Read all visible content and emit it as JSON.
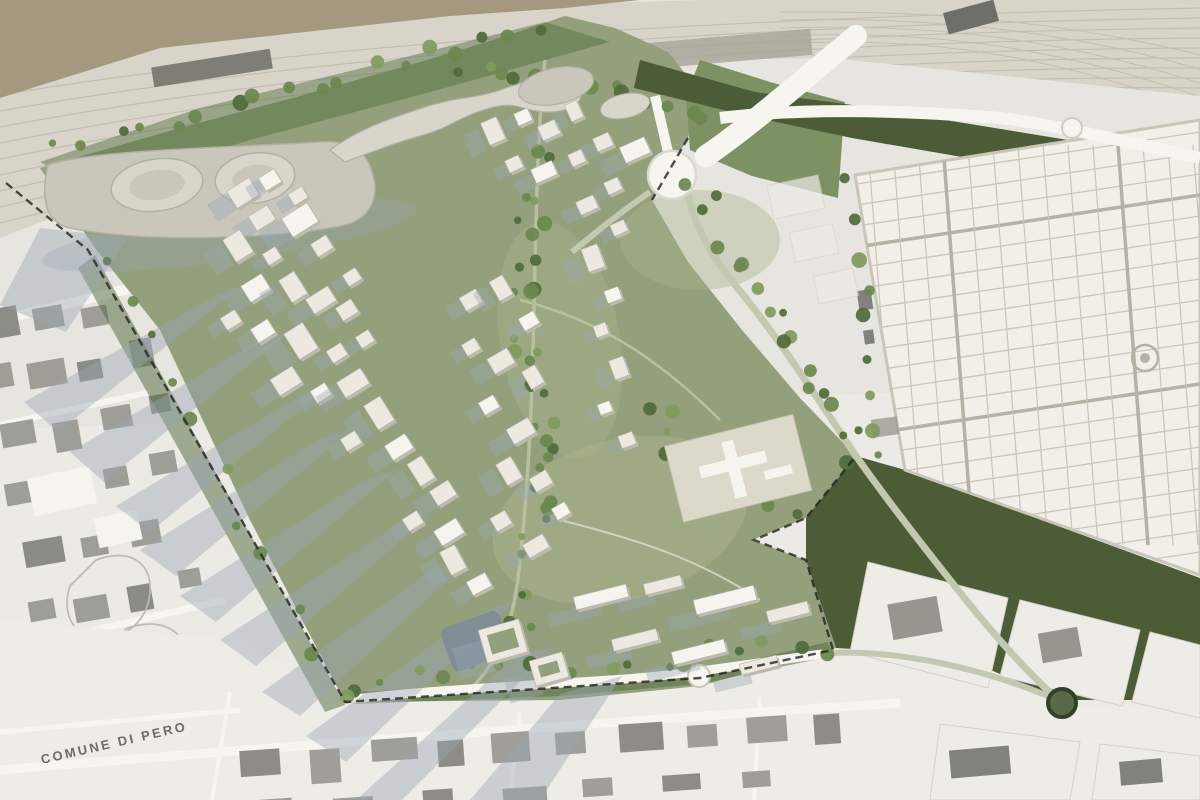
{
  "labels": {
    "municipality": "COMUNE DI PERO"
  },
  "colors": {
    "map_base": "#e7e5df",
    "map_light": "#eeece6",
    "out_of_map": "#a4987f",
    "rail_base": "#d8d4c9",
    "rail_line": "#c2beb1",
    "platform_dark": "#6f6f69",
    "platform_mid": "#a8a49b",
    "road_white": "#f6f5f0",
    "footprint": "#96968f",
    "footprint_dark": "#82827c",
    "parcel_line": "#bdb9ae",
    "site_green": "#93a07b",
    "lawn_green": "#aab38d",
    "park_green": "#7e9163",
    "olive_dark": "#4c5c37",
    "tree_dark": "#4f6a3b",
    "tree_mid": "#6b874e",
    "tree_light": "#7f9a5d",
    "building_roof": "#ebe9e0",
    "building_side": "#bdbaae",
    "building_bright": "#f5f4ef",
    "pavilion_grey": "#c9c6bb",
    "pavilion_light": "#d8d5ca",
    "pavilion_dark": "#b3b0a4",
    "shadow_blue": "#9aa7b5",
    "water_grey": "#7f8b96",
    "cemetery_base": "#f1efe8",
    "cemetery_grid": "#c9c5b8",
    "cemetery_avenue": "#b5b1a4",
    "road_green": "#c3c9b0",
    "path_green": "#b9c09e",
    "boundary_dash": "#22221f",
    "label_grey": "#6f6c64"
  }
}
